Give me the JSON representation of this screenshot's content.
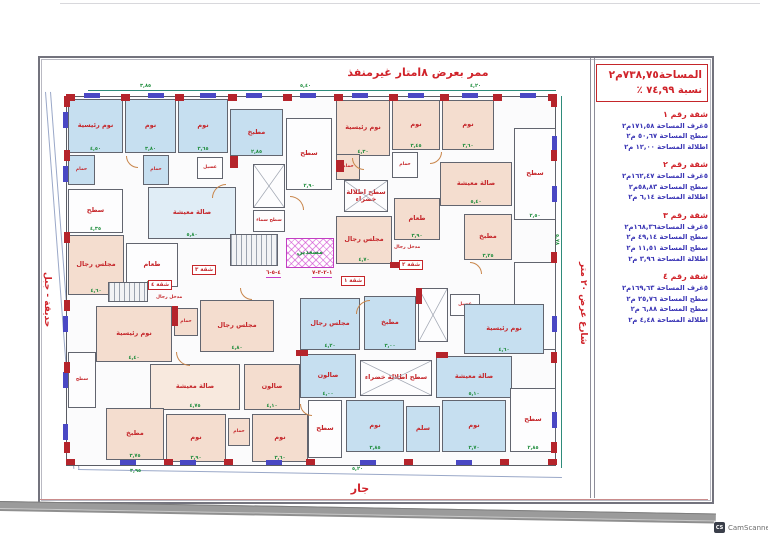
{
  "page": {
    "top_label": "ممر بعرض ٨امتار غيرمنفذ",
    "bottom_label": "جار",
    "left_label": "حديقة - جبل",
    "right_street_label": "شارع عرض ٢٠ متر",
    "watermark_text": "CamScanner",
    "watermark_icon": "CS"
  },
  "info_panel": {
    "title_line1": "المساحة٧٣٨,٧٥م٢",
    "title_line2": "نسبة  ٧٤,٩٩  ٪",
    "apartments": [
      {
        "header": "شقة رقم ١",
        "lines": [
          "٥غرف المساحة ١٧١,٥٨م٢",
          "سطح  المساحة  ٥٠,٦٧ م٢",
          "اطلالة المساحة  ١٢,٠٠  م٢"
        ]
      },
      {
        "header": "شقة رقم ٢",
        "lines": [
          "٥غرف المساحة ١٦٢,٤٧م٢",
          "سطح  المساحة  ٥٨,٨٣م٢",
          "اطلالة المساحة  ٦,١٤  م٢"
        ]
      },
      {
        "header": "شقة رقم ٣",
        "lines": [
          "٥غرف المساحة١٦٨,٣٦م٢",
          "سطح  المساحة  ٤٩,١٤ م٢",
          "سطح  المساحة  ١١,٥١ م٢",
          "اطلالة المساحة  ٣,٩٦ م٢"
        ]
      },
      {
        "header": "شقة رقم ٤",
        "lines": [
          "٥غرف المساحة ١٦٩,٦٣م٢",
          "سطح  المساحة  ٢٥,٧٦ م٢",
          "سطح  المساحة  ٦,٨٨ م٢",
          "اطلالة المساحة  ٤,٤٨ م٢"
        ]
      }
    ]
  },
  "plan": {
    "rooms": [
      {
        "label": "نوم رئيسية",
        "x": 68,
        "y": 99,
        "w": 55,
        "h": 54,
        "fill": "blue",
        "dim": "٤,٥٠"
      },
      {
        "label": "نوم",
        "x": 125,
        "y": 99,
        "w": 51,
        "h": 54,
        "fill": "blue",
        "dim": "٣,٨٠"
      },
      {
        "label": "نوم",
        "x": 178,
        "y": 99,
        "w": 50,
        "h": 54,
        "fill": "blue",
        "dim": "٣,٦٥"
      },
      {
        "label": "مطبخ",
        "x": 230,
        "y": 109,
        "w": 53,
        "h": 47,
        "fill": "blue",
        "dim": "٢,٨٥"
      },
      {
        "label": "حمام",
        "x": 68,
        "y": 155,
        "w": 27,
        "h": 30,
        "fill": "blue"
      },
      {
        "label": "حمام",
        "x": 143,
        "y": 155,
        "w": 26,
        "h": 30,
        "fill": "blue"
      },
      {
        "label": "غسيل",
        "x": 197,
        "y": 157,
        "w": 26,
        "h": 22,
        "fill": "white"
      },
      {
        "label": "سطح",
        "x": 68,
        "y": 189,
        "w": 55,
        "h": 44,
        "fill": "white",
        "dim": "٤,٣٥"
      },
      {
        "label": "صالة معيشة",
        "x": 148,
        "y": 187,
        "w": 88,
        "h": 52,
        "fill": "lightblue",
        "dim": "٥,٨٠"
      },
      {
        "label": "طعام",
        "x": 126,
        "y": 243,
        "w": 52,
        "h": 44,
        "fill": "white",
        "dim": "٤,٢٠"
      },
      {
        "label": "مجلس رجال",
        "x": 68,
        "y": 235,
        "w": 56,
        "h": 60,
        "fill": "peach",
        "dim": "٤,٦٠"
      },
      {
        "label": "سطح",
        "x": 286,
        "y": 118,
        "w": 46,
        "h": 72,
        "fill": "white",
        "dim": "٢,٩٠"
      },
      {
        "label": "",
        "x": 253,
        "y": 164,
        "w": 32,
        "h": 44,
        "fill": "white",
        "cross": true
      },
      {
        "label": "سطح سماء",
        "x": 253,
        "y": 210,
        "w": 32,
        "h": 22,
        "fill": "white"
      },
      {
        "label": "",
        "x": 230,
        "y": 234,
        "w": 48,
        "h": 32,
        "fill": "white",
        "treads": true
      },
      {
        "label": "مصعدين",
        "x": 286,
        "y": 238,
        "w": 48,
        "h": 30,
        "fill": "magenta"
      },
      {
        "label": "",
        "x": 108,
        "y": 282,
        "w": 40,
        "h": 20,
        "fill": "white",
        "treads": true
      },
      {
        "label": "نوم رئيسية",
        "x": 336,
        "y": 100,
        "w": 54,
        "h": 56,
        "fill": "peach",
        "dim": "٤,٣٠"
      },
      {
        "label": "نوم",
        "x": 392,
        "y": 100,
        "w": 48,
        "h": 50,
        "fill": "peach",
        "dim": "٣,٤٥"
      },
      {
        "label": "نوم",
        "x": 442,
        "y": 100,
        "w": 52,
        "h": 50,
        "fill": "peach",
        "dim": "٣,٦٠"
      },
      {
        "label": "حمام",
        "x": 336,
        "y": 154,
        "w": 24,
        "h": 26,
        "fill": "peach"
      },
      {
        "label": "حمام",
        "x": 392,
        "y": 152,
        "w": 26,
        "h": 26,
        "fill": "white"
      },
      {
        "label": "سطح اطلالة خضراء",
        "x": 344,
        "y": 180,
        "w": 44,
        "h": 32,
        "fill": "white",
        "cross": true
      },
      {
        "label": "صالة معيشة",
        "x": 440,
        "y": 162,
        "w": 72,
        "h": 44,
        "fill": "peach",
        "dim": "٥,٤٠"
      },
      {
        "label": "طعام",
        "x": 394,
        "y": 198,
        "w": 46,
        "h": 42,
        "fill": "peach",
        "dim": "٣,٩٠"
      },
      {
        "label": "مجلس رجال",
        "x": 336,
        "y": 216,
        "w": 56,
        "h": 48,
        "fill": "peach",
        "dim": "٤,٧٠"
      },
      {
        "label": "مطبخ",
        "x": 464,
        "y": 214,
        "w": 48,
        "h": 46,
        "fill": "peach",
        "dim": "٣,٢٥"
      },
      {
        "label": "سطح",
        "x": 514,
        "y": 128,
        "w": 42,
        "h": 92,
        "fill": "white",
        "dim": "٢,٥٠"
      },
      {
        "label": "",
        "x": 514,
        "y": 262,
        "w": 42,
        "h": 88,
        "fill": "white"
      },
      {
        "label": "نوم رئيسية",
        "x": 96,
        "y": 306,
        "w": 76,
        "h": 56,
        "fill": "peach",
        "dim": "٤,٤٠"
      },
      {
        "label": "حمام",
        "x": 174,
        "y": 308,
        "w": 24,
        "h": 28,
        "fill": "peach"
      },
      {
        "label": "مجلس رجال",
        "x": 200,
        "y": 300,
        "w": 74,
        "h": 52,
        "fill": "peach",
        "dim": "٤,٨٠"
      },
      {
        "label": "سطح",
        "x": 68,
        "y": 352,
        "w": 28,
        "h": 56,
        "fill": "white"
      },
      {
        "label": "صالة معيشة",
        "x": 150,
        "y": 364,
        "w": 90,
        "h": 46,
        "fill": "lightpeach",
        "dim": "٤,٧٥"
      },
      {
        "label": "صالون",
        "x": 244,
        "y": 364,
        "w": 56,
        "h": 46,
        "fill": "peach",
        "dim": "٤,١٠"
      },
      {
        "label": "مطبخ",
        "x": 106,
        "y": 408,
        "w": 58,
        "h": 52,
        "fill": "peach",
        "dim": "٣,٧٥"
      },
      {
        "label": "نوم",
        "x": 166,
        "y": 414,
        "w": 60,
        "h": 48,
        "fill": "peach",
        "dim": "٣,٩٠"
      },
      {
        "label": "حمام",
        "x": 228,
        "y": 418,
        "w": 22,
        "h": 28,
        "fill": "peach"
      },
      {
        "label": "نوم",
        "x": 252,
        "y": 414,
        "w": 56,
        "h": 48,
        "fill": "peach",
        "dim": "٣,٦٠"
      },
      {
        "label": "مجلس رجال",
        "x": 300,
        "y": 298,
        "w": 60,
        "h": 52,
        "fill": "blue",
        "dim": "٤,٢٠"
      },
      {
        "label": "مطبخ",
        "x": 364,
        "y": 296,
        "w": 52,
        "h": 54,
        "fill": "blue",
        "dim": "٣,٠٠"
      },
      {
        "label": "",
        "x": 418,
        "y": 288,
        "w": 30,
        "h": 54,
        "fill": "white",
        "cross": true
      },
      {
        "label": "غسيل",
        "x": 450,
        "y": 294,
        "w": 30,
        "h": 22,
        "fill": "white"
      },
      {
        "label": "نوم رئيسية",
        "x": 464,
        "y": 304,
        "w": 80,
        "h": 50,
        "fill": "blue",
        "dim": "٤,٦٠"
      },
      {
        "label": "صالون",
        "x": 300,
        "y": 354,
        "w": 56,
        "h": 44,
        "fill": "blue",
        "dim": "٤,٠٠"
      },
      {
        "label": "سطح اطلالة خضراء",
        "x": 360,
        "y": 360,
        "w": 72,
        "h": 36,
        "fill": "white",
        "cross": true
      },
      {
        "label": "صالة معيشة",
        "x": 436,
        "y": 356,
        "w": 76,
        "h": 42,
        "fill": "blue",
        "dim": "٥,١٠"
      },
      {
        "label": "سطح",
        "x": 308,
        "y": 400,
        "w": 34,
        "h": 58,
        "fill": "white"
      },
      {
        "label": "نوم",
        "x": 346,
        "y": 400,
        "w": 58,
        "h": 52,
        "fill": "blue",
        "dim": "٣,٨٥"
      },
      {
        "label": "سلم",
        "x": 406,
        "y": 406,
        "w": 34,
        "h": 46,
        "fill": "blue"
      },
      {
        "label": "نوم",
        "x": 442,
        "y": 400,
        "w": 64,
        "h": 52,
        "fill": "blue",
        "dim": "٣,٧٠"
      },
      {
        "label": "سطح",
        "x": 510,
        "y": 388,
        "w": 46,
        "h": 64,
        "fill": "white",
        "dim": "٢,٨٥"
      }
    ],
    "windows": [
      {
        "x": 84,
        "y": 93,
        "w": 16,
        "h": 5
      },
      {
        "x": 148,
        "y": 93,
        "w": 16,
        "h": 5
      },
      {
        "x": 200,
        "y": 93,
        "w": 16,
        "h": 5
      },
      {
        "x": 246,
        "y": 93,
        "w": 16,
        "h": 5
      },
      {
        "x": 300,
        "y": 93,
        "w": 16,
        "h": 5
      },
      {
        "x": 352,
        "y": 93,
        "w": 16,
        "h": 5
      },
      {
        "x": 408,
        "y": 93,
        "w": 16,
        "h": 5
      },
      {
        "x": 462,
        "y": 93,
        "w": 16,
        "h": 5
      },
      {
        "x": 520,
        "y": 93,
        "w": 16,
        "h": 5
      },
      {
        "x": 63,
        "y": 112,
        "w": 5,
        "h": 16
      },
      {
        "x": 63,
        "y": 166,
        "w": 5,
        "h": 16
      },
      {
        "x": 63,
        "y": 316,
        "w": 5,
        "h": 16
      },
      {
        "x": 63,
        "y": 372,
        "w": 5,
        "h": 16
      },
      {
        "x": 63,
        "y": 424,
        "w": 5,
        "h": 16
      },
      {
        "x": 552,
        "y": 136,
        "w": 5,
        "h": 16
      },
      {
        "x": 552,
        "y": 186,
        "w": 5,
        "h": 16
      },
      {
        "x": 552,
        "y": 316,
        "w": 5,
        "h": 16
      },
      {
        "x": 552,
        "y": 412,
        "w": 5,
        "h": 16
      },
      {
        "x": 120,
        "y": 460,
        "w": 16,
        "h": 5
      },
      {
        "x": 180,
        "y": 460,
        "w": 16,
        "h": 5
      },
      {
        "x": 266,
        "y": 460,
        "w": 16,
        "h": 5
      },
      {
        "x": 360,
        "y": 460,
        "w": 16,
        "h": 5
      },
      {
        "x": 456,
        "y": 460,
        "w": 16,
        "h": 5
      }
    ],
    "walls": [
      {
        "x": 66,
        "y": 94,
        "w": 9,
        "h": 7
      },
      {
        "x": 121,
        "y": 94,
        "w": 9,
        "h": 7
      },
      {
        "x": 175,
        "y": 94,
        "w": 9,
        "h": 7
      },
      {
        "x": 228,
        "y": 94,
        "w": 9,
        "h": 7
      },
      {
        "x": 283,
        "y": 94,
        "w": 9,
        "h": 7
      },
      {
        "x": 334,
        "y": 94,
        "w": 9,
        "h": 7
      },
      {
        "x": 389,
        "y": 94,
        "w": 9,
        "h": 7
      },
      {
        "x": 440,
        "y": 94,
        "w": 9,
        "h": 7
      },
      {
        "x": 493,
        "y": 94,
        "w": 9,
        "h": 7
      },
      {
        "x": 548,
        "y": 94,
        "w": 9,
        "h": 7
      },
      {
        "x": 64,
        "y": 96,
        "w": 6,
        "h": 11
      },
      {
        "x": 64,
        "y": 150,
        "w": 6,
        "h": 11
      },
      {
        "x": 64,
        "y": 232,
        "w": 6,
        "h": 11
      },
      {
        "x": 64,
        "y": 300,
        "w": 6,
        "h": 11
      },
      {
        "x": 64,
        "y": 362,
        "w": 6,
        "h": 11
      },
      {
        "x": 64,
        "y": 442,
        "w": 6,
        "h": 11
      },
      {
        "x": 551,
        "y": 96,
        "w": 6,
        "h": 11
      },
      {
        "x": 551,
        "y": 150,
        "w": 6,
        "h": 11
      },
      {
        "x": 551,
        "y": 252,
        "w": 6,
        "h": 11
      },
      {
        "x": 551,
        "y": 352,
        "w": 6,
        "h": 11
      },
      {
        "x": 551,
        "y": 442,
        "w": 6,
        "h": 11
      },
      {
        "x": 66,
        "y": 459,
        "w": 9,
        "h": 6
      },
      {
        "x": 164,
        "y": 459,
        "w": 9,
        "h": 6
      },
      {
        "x": 224,
        "y": 459,
        "w": 9,
        "h": 6
      },
      {
        "x": 306,
        "y": 459,
        "w": 9,
        "h": 6
      },
      {
        "x": 404,
        "y": 459,
        "w": 9,
        "h": 6
      },
      {
        "x": 500,
        "y": 459,
        "w": 9,
        "h": 6
      },
      {
        "x": 548,
        "y": 459,
        "w": 9,
        "h": 6
      },
      {
        "x": 230,
        "y": 156,
        "w": 8,
        "h": 12
      },
      {
        "x": 336,
        "y": 160,
        "w": 8,
        "h": 12
      },
      {
        "x": 390,
        "y": 262,
        "w": 14,
        "h": 6
      },
      {
        "x": 172,
        "y": 306,
        "w": 6,
        "h": 20
      },
      {
        "x": 416,
        "y": 288,
        "w": 6,
        "h": 16
      },
      {
        "x": 296,
        "y": 350,
        "w": 12,
        "h": 6
      },
      {
        "x": 436,
        "y": 352,
        "w": 12,
        "h": 6
      }
    ],
    "tags": [
      {
        "t": "شقة ١",
        "x": 341,
        "y": 276
      },
      {
        "t": "شقة ٢",
        "x": 399,
        "y": 260
      },
      {
        "t": "شقة ٣",
        "x": 192,
        "y": 265
      },
      {
        "t": "شقة ٤",
        "x": 148,
        "y": 280
      }
    ],
    "rednums": [
      {
        "t": "٤-٥-٦",
        "x": 266,
        "y": 270
      },
      {
        "t": "١-٢-٣-٧",
        "x": 312,
        "y": 270
      }
    ],
    "small_red_labels": [
      {
        "t": "مدخل رجال",
        "x": 156,
        "y": 296
      },
      {
        "t": "مدخل رجال",
        "x": 394,
        "y": 246
      }
    ],
    "gdims": [
      {
        "t": "٣,٨٥",
        "x": 140,
        "y": 83
      },
      {
        "t": "٥,٤٠",
        "x": 300,
        "y": 83
      },
      {
        "t": "٤,٢٠",
        "x": 470,
        "y": 83
      },
      {
        "t": "٥,٧٨",
        "x": 560,
        "y": 234,
        "rot": 90
      },
      {
        "t": "٣,٩٥",
        "x": 130,
        "y": 468
      },
      {
        "t": "٥,٢٠",
        "x": 352,
        "y": 466
      }
    ],
    "doors": [
      {
        "x": 126,
        "y": 156,
        "s": 12,
        "r": 0
      },
      {
        "x": 212,
        "y": 184,
        "s": 14,
        "r": 90
      },
      {
        "x": 290,
        "y": 196,
        "s": 14,
        "r": 180
      },
      {
        "x": 352,
        "y": 158,
        "s": 12,
        "r": 0
      },
      {
        "x": 430,
        "y": 152,
        "s": 12,
        "r": 270
      },
      {
        "x": 176,
        "y": 352,
        "s": 14,
        "r": 0
      },
      {
        "x": 356,
        "y": 300,
        "s": 14,
        "r": 90
      },
      {
        "x": 300,
        "y": 404,
        "s": 12,
        "r": 0
      },
      {
        "x": 470,
        "y": 262,
        "s": 12,
        "r": 180
      },
      {
        "x": 240,
        "y": 288,
        "s": 12,
        "r": 0
      }
    ]
  },
  "colors": {
    "wall_red": "#b5242b",
    "window_blue": "#4a48c4",
    "room_blue": "#c6dff0",
    "room_peach": "#f4ddcf",
    "label_red": "#c5262a",
    "dim_green": "#1e8c3c",
    "axis_teal": "#2e8b7a",
    "elevator_magenta": "#c23ec2",
    "panel_title_red": "#d0232a",
    "panel_stat_blue": "#3a35b5"
  }
}
